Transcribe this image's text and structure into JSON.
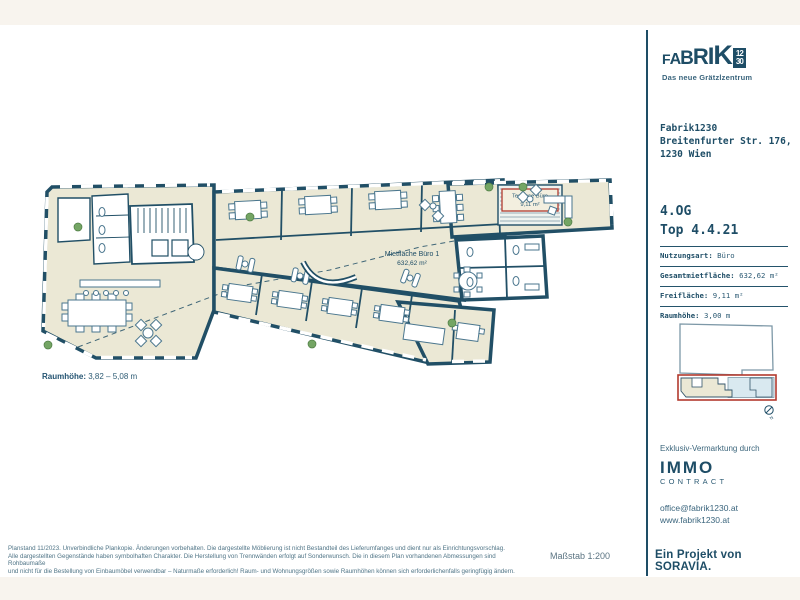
{
  "plan": {
    "mietflaeche_label": "Mietfläche Büro 1",
    "mietflaeche_area": "632,62 m²",
    "terrasse_label": "Terrasse Büro",
    "terrasse_area": "9,11 m²",
    "raumhoehe_label": "Raumhöhe:",
    "raumhoehe_value": "3,82 – 5,08 m",
    "compass_label": "N"
  },
  "sidebar": {
    "logo": {
      "l1": "F",
      "l2": "A",
      "l3": "B",
      "l4": "R",
      "l5": "I",
      "l6": "K",
      "badge_top": "12",
      "badge_bottom": "30",
      "tagline": "Das neue Grätzlzentrum"
    },
    "address": {
      "line1": "Fabrik1230",
      "line2": "Breitenfurter Str. 176,",
      "line3": "1230 Wien"
    },
    "unit": {
      "floor": "4.OG",
      "top": "Top 4.4.21"
    },
    "specs": [
      {
        "label": "Nutzungsart:",
        "value": "Büro"
      },
      {
        "label": "Gesamtmietfläche:",
        "value": "632,62 m²"
      },
      {
        "label": "Freifläche:",
        "value": "9,11 m²"
      },
      {
        "label": "Raumhöhe:",
        "value": "3,00 m"
      }
    ],
    "marketing": {
      "heading": "Exklusiv-Vermarktung durch",
      "brand": "IMMO",
      "brand_sub": "CONTRACT",
      "email": "office@fabrik1230.at",
      "website": "www.fabrik1230.at"
    }
  },
  "footer": {
    "disclaimer_line1": "Planstand 11/2023. Unverbindliche Plankopie. Änderungen vorbehalten. Die dargestellte Möblierung ist nicht Bestandteil des Lieferumfanges und dient nur als Einrichtungsvorschlag.",
    "disclaimer_line2": "Alle dargestellten Gegenstände haben symbolhaften Charakter. Die Herstellung von Trennwänden erfolgt auf Sonderwunsch. Die in diesem Plan vorhandenen Abmessungen sind Rohbaumaße",
    "disclaimer_line3": "und nicht für die Bestellung von Einbaumöbel verwendbar – Naturmaße erforderlich! Raum- und Wohnungsgrößen sowie Raumhöhen können sich erforderlichenfalls geringfügig ändern.",
    "scale": "Maßstab 1:200",
    "project": "Ein Projekt von SORAVIA."
  },
  "colors": {
    "wall": "#1e4d66",
    "floor": "#ebe8d5",
    "furniture": "#4a768e",
    "terrace_box": "#b23a2e",
    "plant": "#74a564",
    "background_band": "#f8f4ee"
  }
}
